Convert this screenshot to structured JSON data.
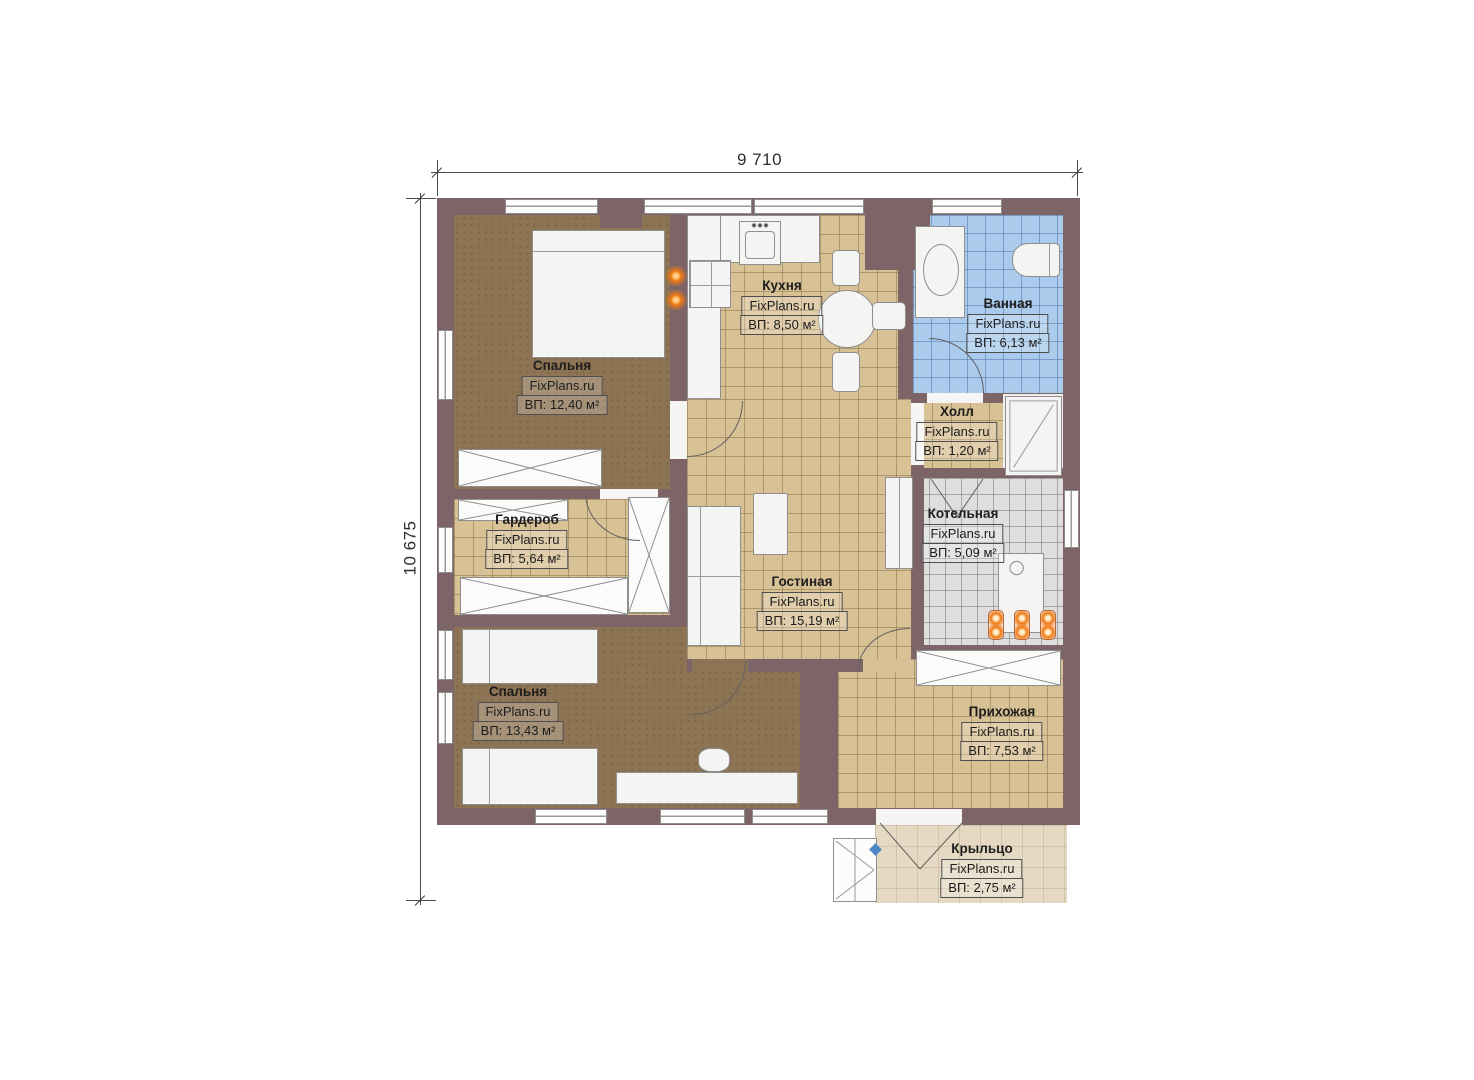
{
  "plan_title": "Floor plan (FixPlans.ru)",
  "dimensions": {
    "width_label": "9 710",
    "height_label": "10 675"
  },
  "rooms": [
    {
      "id": "bedroom-top",
      "name": "Спальня",
      "brand": "FixPlans.ru",
      "area": "ВП: 12,40 м²"
    },
    {
      "id": "kitchen",
      "name": "Кухня",
      "brand": "FixPlans.ru",
      "area": "ВП: 8,50 м²"
    },
    {
      "id": "bathroom",
      "name": "Ванная",
      "brand": "FixPlans.ru",
      "area": "ВП: 6,13 м²"
    },
    {
      "id": "hall",
      "name": "Холл",
      "brand": "FixPlans.ru",
      "area": "ВП: 1,20 м²"
    },
    {
      "id": "wardrobe",
      "name": "Гардероб",
      "brand": "FixPlans.ru",
      "area": "ВП: 5,64 м²"
    },
    {
      "id": "boiler",
      "name": "Котельная",
      "brand": "FixPlans.ru",
      "area": "ВП: 5,09 м²"
    },
    {
      "id": "living",
      "name": "Гостиная",
      "brand": "FixPlans.ru",
      "area": "ВП: 15,19 м²"
    },
    {
      "id": "bedroom-bottom",
      "name": "Спальня",
      "brand": "FixPlans.ru",
      "area": "ВП: 13,43 м²"
    },
    {
      "id": "entry",
      "name": "Прихожая",
      "brand": "FixPlans.ru",
      "area": "ВП: 7,53 м²"
    },
    {
      "id": "porch",
      "name": "Крыльцо",
      "brand": "FixPlans.ru",
      "area": "ВП: 2,75 м²"
    }
  ],
  "colors": {
    "wall": "#7d6466",
    "wood": "#8d7454",
    "tan": "#d8c195",
    "blue": "#abcbec",
    "gray": "#dedede",
    "porch": "#e6d9c3",
    "accent": "#f07812"
  }
}
